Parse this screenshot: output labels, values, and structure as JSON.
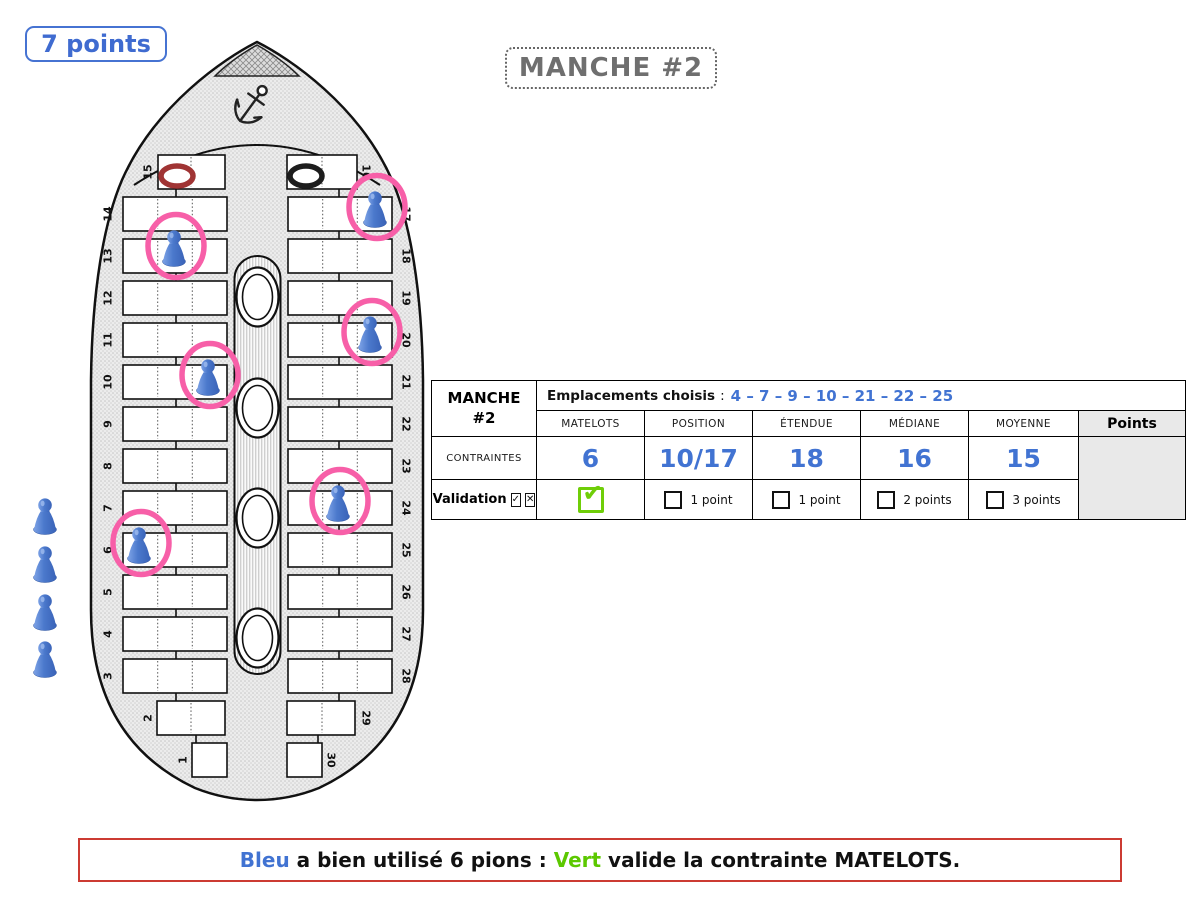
{
  "badge": {
    "label": "7 points"
  },
  "title": {
    "label": "MANCHE #2"
  },
  "boat": {
    "bench_labels": [
      "1",
      "2",
      "3",
      "4",
      "5",
      "6",
      "7",
      "8",
      "9",
      "10",
      "11",
      "12",
      "13",
      "14",
      "15",
      "16",
      "17",
      "18",
      "19",
      "20",
      "21",
      "22",
      "23",
      "24",
      "25",
      "26",
      "27",
      "28",
      "29",
      "30"
    ],
    "rings": [
      {
        "bench": 15,
        "color": "#a03434"
      },
      {
        "bench": 16,
        "color": "#1d1d1d"
      }
    ],
    "pawn_benches": [
      6,
      10,
      13,
      17,
      20,
      24
    ],
    "reserve_pawn_count": 4,
    "pawn_color": "#4b79cc",
    "highlight_ring_color": "#f75fa8"
  },
  "table": {
    "round_label_line1": "MANCHE",
    "round_label_line2": "#2",
    "emplacements_label": "Emplacements choisis",
    "emplacements_separator": ":",
    "emplacements_values": "4 – 7 – 9 – 10 – 21 – 22 – 25",
    "columns": [
      "MATELOTS",
      "POSITION",
      "ÉTENDUE",
      "MÉDIANE",
      "MOYENNE"
    ],
    "points_label": "Points",
    "contraintes_label": "CONTRAINTES",
    "values": [
      "6",
      "10/17",
      "18",
      "16",
      "15"
    ],
    "validation_label": "Validation",
    "validation_check_glyph": "✓",
    "validation_cross_glyph": "✕",
    "matelots_checked_glyph": "✔",
    "point_labels": [
      "1 point",
      "1 point",
      "2 points",
      "3 points"
    ]
  },
  "banner": {
    "segments": [
      {
        "text": "Bleu",
        "color": "#4173d2"
      },
      {
        "text": " a bien utilisé 6 pions : ",
        "color": "#111111"
      },
      {
        "text": "Vert",
        "color": "#5cc800"
      },
      {
        "text": " valide la contrainte MATELOTS.",
        "color": "#111111"
      }
    ]
  }
}
